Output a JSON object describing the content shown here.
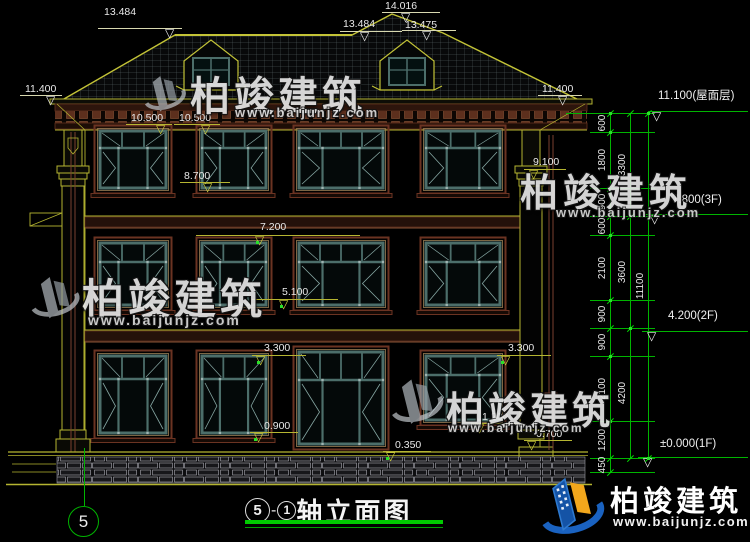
{
  "colors": {
    "background": "#000000",
    "dimension_green": "#00b400",
    "outline_yellow": "#b5b531",
    "brand_blue": "#1a62c0",
    "brand_yellow": "#f2a71c"
  },
  "watermarks": {
    "brand": "柏竣建筑",
    "url": "www.baijunjz.com"
  },
  "brand_footer": {
    "name": "柏竣建筑",
    "url": "www.baijunjz.com"
  },
  "drawing_title": {
    "axis_left": "5",
    "dash": "-",
    "axis_right": "1",
    "name": "轴立面图"
  },
  "axis_bubble_label": "5",
  "roof_flags": [
    "13.484",
    "14.016",
    "13.484",
    "13.475"
  ],
  "eave_flags": [
    "11.400",
    "11.400"
  ],
  "level_flags": [
    "11.100(屋面层)",
    "7.800(3F)",
    "4.200(2F)",
    "±0.000(1F)"
  ],
  "facade_markers": [
    "10.500",
    "10.500",
    "8.700",
    "9.100",
    "7.200",
    "5.100",
    "3.300",
    "3.300",
    "0.900",
    "1.200",
    "0.350",
    "0.700"
  ],
  "dim_chains": {
    "inner": [
      "600",
      "1800",
      "900",
      "600",
      "2100",
      "900",
      "900",
      "2100",
      "1200",
      "450"
    ],
    "middle": [
      "3300",
      "3600",
      "4200"
    ],
    "outer": [
      "11100"
    ]
  }
}
